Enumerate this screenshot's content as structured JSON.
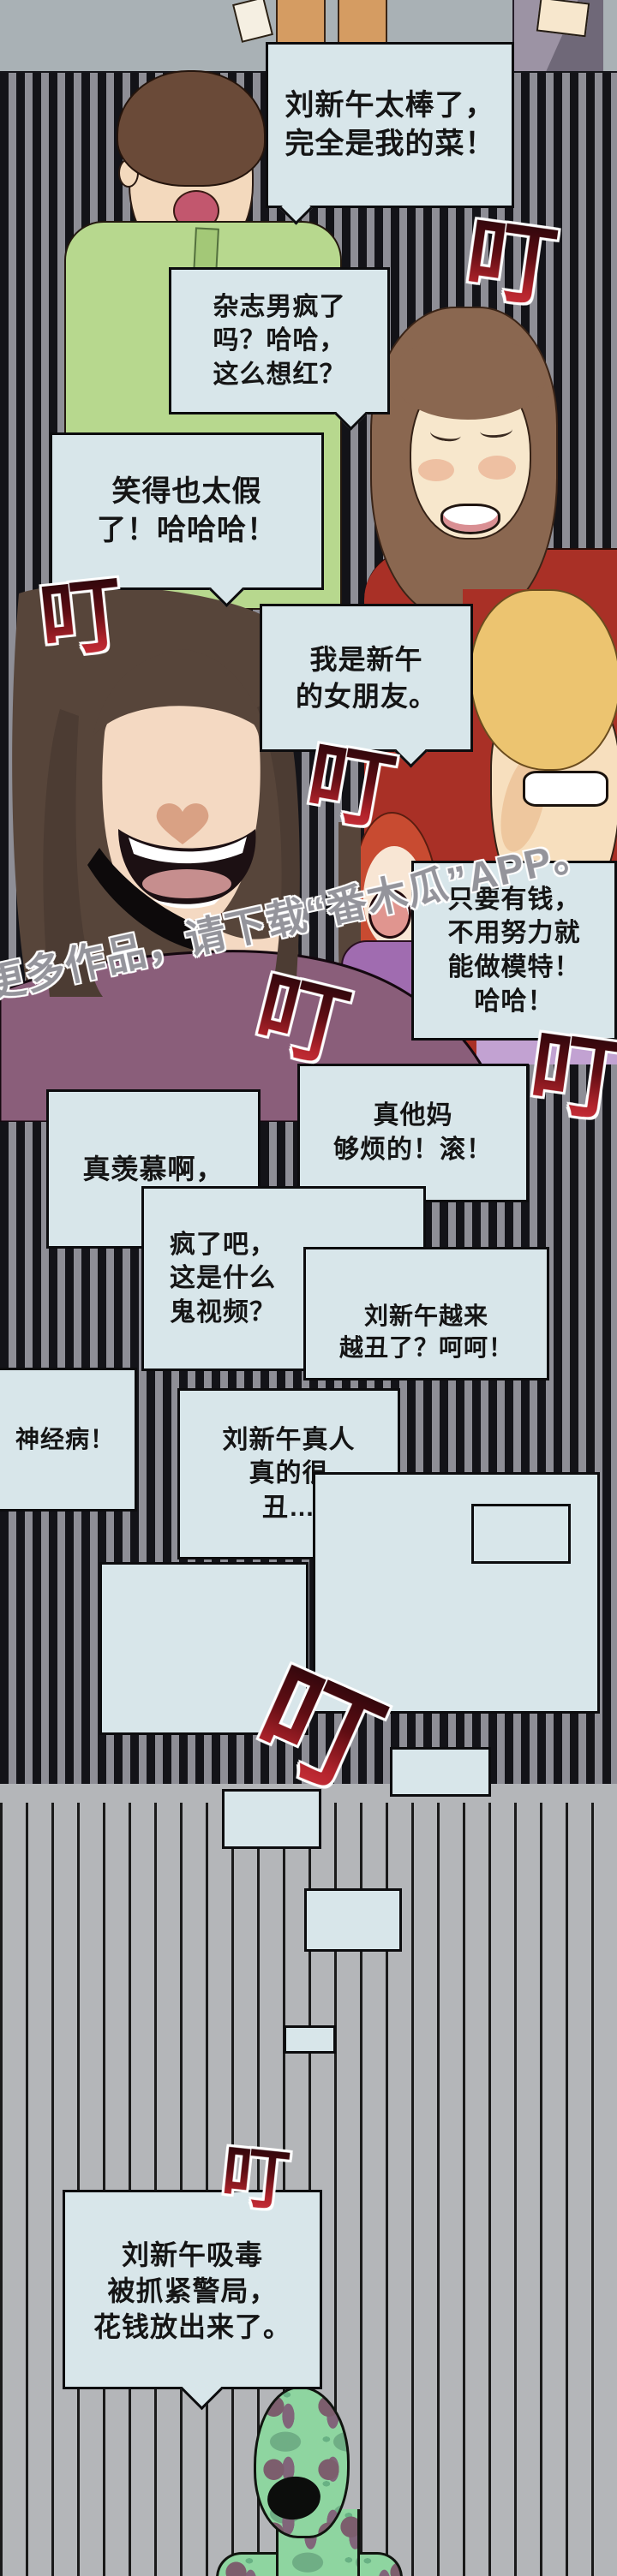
{
  "page_type": "webtoon-comic-page",
  "watermark": {
    "text": "更多作品，请下载“番木瓜”APP。"
  },
  "stamp": {
    "text": "叮"
  },
  "bubbles": {
    "b1": {
      "lines": [
        "刘新午太棒了，",
        "完全是我的菜！"
      ]
    },
    "b2": {
      "lines": [
        "杂志男疯了",
        "吗？哈哈，",
        "这么想红？"
      ]
    },
    "b3": {
      "lines": [
        "笑得也太假",
        "了！哈哈哈！"
      ]
    },
    "b4": {
      "lines": [
        "我是新午",
        "的女朋友。"
      ]
    },
    "b5": {
      "lines": [
        "只要有钱，",
        "不用努力就",
        "能做模特！",
        "哈哈！"
      ]
    },
    "b6": {
      "lines": [
        "真羡慕啊，"
      ]
    },
    "b7": {
      "lines": [
        "真他妈",
        "够烦的！滚！"
      ]
    },
    "b8": {
      "lines": [
        "疯了吧，",
        "这是什么",
        "鬼视频？"
      ]
    },
    "b9": {
      "lines": [
        "刘新午越来",
        "越丑了？呵呵！"
      ]
    },
    "b10": {
      "lines": [
        "神经病！"
      ]
    },
    "b11": {
      "lines": [
        "刘新午真人",
        "真的很",
        "丑…"
      ]
    },
    "b19": {
      "lines": [
        "刘新午吸毒",
        "被抓紧警局，",
        "花钱放出来了。"
      ]
    }
  },
  "colors": {
    "bubble_fill": "#d8e6ea",
    "bubble_border": "#0c0c0e",
    "stamp_red": "#c9303a",
    "stamp_dark": "#2b060b",
    "watermark_gray": "#94949b",
    "stripe_black": "#131318",
    "stripe_gray": "#8e8e96",
    "lower_bg_gray": "#b4b6b9",
    "top_band_gray": "#a9b1b5",
    "skin": "#f4d9c2",
    "hair_dark_brown": "#57453a",
    "hair_wavy_brown": "#8a6750",
    "hair_blonde": "#ecc470",
    "hair_red": "#c84b31",
    "shirt_green": "#b7d88e",
    "shirt_red": "#a93026",
    "shirt_plum": "#8a5e7a",
    "top_purple": "#a06cb0",
    "shirt_lavender": "#c2a2d2",
    "creature_green": "#8ed5a0"
  }
}
